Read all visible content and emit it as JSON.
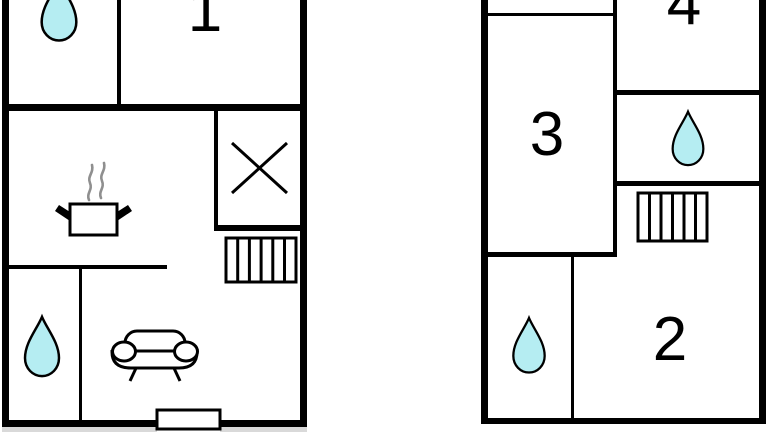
{
  "image_type": "floor-plan-diagram",
  "colors": {
    "wall": "#000000",
    "water_fill": "#b5edf2",
    "steam": "#8f8f8f",
    "background": "#ffffff",
    "shadow": "#d9d9d9"
  },
  "plans": {
    "left": {
      "name": "floor-plan-left",
      "rooms": [
        {
          "label": "1"
        }
      ],
      "icons": [
        {
          "name": "water-drop-icon",
          "meaning": "bathroom"
        },
        {
          "name": "cooking-pot-icon",
          "meaning": "kitchen"
        },
        {
          "name": "steam-icon",
          "meaning": "kitchen"
        },
        {
          "name": "x-mark-icon",
          "meaning": "shaft"
        },
        {
          "name": "stairs-icon",
          "meaning": "stairs"
        },
        {
          "name": "sofa-icon",
          "meaning": "living room"
        },
        {
          "name": "water-drop-icon",
          "meaning": "bathroom"
        },
        {
          "name": "entrance-door",
          "meaning": "entrance"
        }
      ]
    },
    "right": {
      "name": "floor-plan-right",
      "rooms": [
        {
          "label": "3"
        },
        {
          "label": "4"
        },
        {
          "label": "2"
        }
      ],
      "icons": [
        {
          "name": "water-drop-icon",
          "meaning": "bathroom"
        },
        {
          "name": "stairs-icon",
          "meaning": "stairs"
        },
        {
          "name": "water-drop-icon",
          "meaning": "bathroom"
        }
      ]
    }
  }
}
